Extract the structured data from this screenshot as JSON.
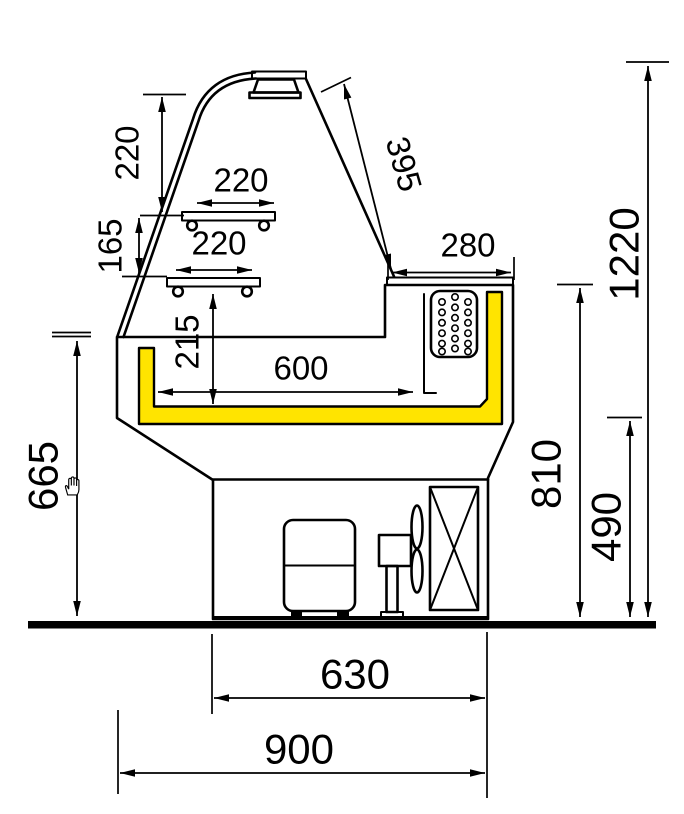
{
  "colors": {
    "outline": "#000000",
    "highlight": "#ffe400",
    "background": "#ffffff"
  },
  "cursor": "hand-grab",
  "dims": {
    "canopy_height": "220",
    "shelf_upper_width": "220",
    "shelf_lower_width": "220",
    "shelf_gap": "165",
    "well_depth": "215",
    "glass_length": "395",
    "top_shelf_depth": "280",
    "deck_width": "600",
    "total_height": "1220",
    "counter_height": "810",
    "base_height": "490",
    "front_height": "665",
    "base_depth": "630",
    "total_depth": "900"
  }
}
